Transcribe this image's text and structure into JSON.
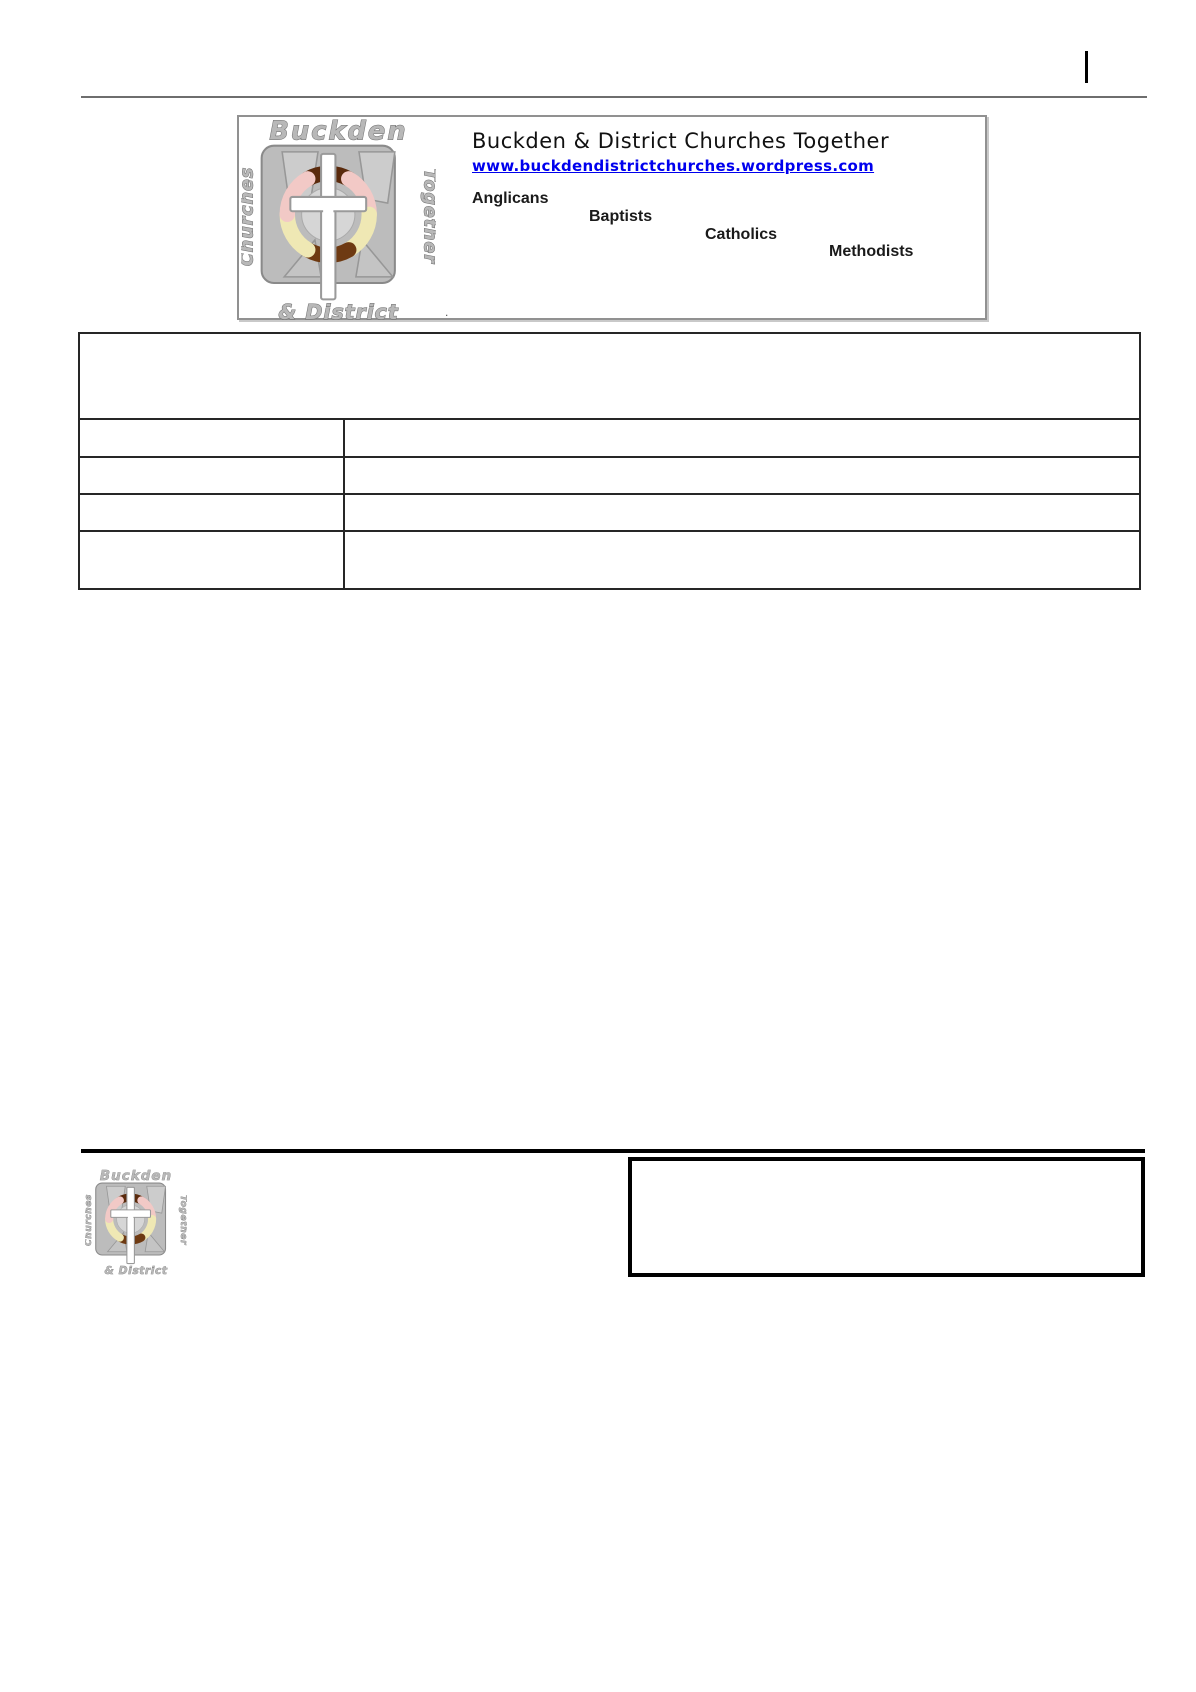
{
  "header": {
    "title": "Buckden & District Churches Together",
    "url": "www.buckdendistrictchurches.wordpress.com",
    "denominations": [
      "Anglicans",
      "Baptists",
      "Catholics",
      "Methodists"
    ],
    "stray_mark": "."
  },
  "logo": {
    "top": "Buckden",
    "left": "Churches",
    "right": "Together",
    "bottom": "& District"
  },
  "table": {
    "header_cell": "",
    "rows": [
      {
        "left": "",
        "right": ""
      },
      {
        "left": "",
        "right": ""
      },
      {
        "left": "",
        "right": ""
      },
      {
        "left": "",
        "right": ""
      }
    ]
  },
  "footer": {
    "note_box": ""
  },
  "colors": {
    "link_blue": "#0000ee",
    "rule_gray": "#6e6e6e",
    "table_border": "#262626",
    "logo_gray": "#b8b8b8",
    "arm_dark_brown": "#5a2a0c",
    "arm_brown": "#6e3a12",
    "arm_pink": "#f2c9c6",
    "arm_cream": "#efe8b4",
    "black": "#000000"
  }
}
